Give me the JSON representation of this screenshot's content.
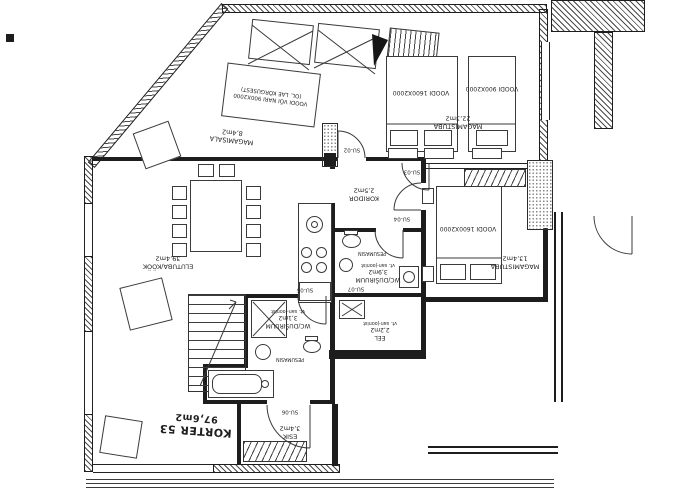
{
  "plan": {
    "title": "KORTER 53",
    "title_area": "97,6m2",
    "rooms": {
      "elutuba": {
        "name": "ELUTUBA/KÖÖK",
        "area": "39,4m2"
      },
      "magamisala": {
        "name": "MAGAMISALA",
        "area": "8,4m2"
      },
      "magamistuba_suur": {
        "name": "MAGAMISTUBA",
        "area": "22,3m2"
      },
      "magamistuba_vaike": {
        "name": "MAGAMISTUBA",
        "area": "13,4m2"
      },
      "koridor": {
        "name": "KORIDOR",
        "area": "2,5m2"
      },
      "wc_suur": {
        "name": "WC/DUŠIRUUM",
        "area": "3,9m2",
        "note": "vt. san-joonist"
      },
      "wc_vaike": {
        "name": "WC/DUŠIRUUM",
        "area": "3,1m2",
        "note": "vt. san-joonist"
      },
      "eel": {
        "name": "EEL",
        "area": "2,2m2",
        "note": "vt. san-joonist"
      },
      "esik": {
        "name": "ESIK",
        "area": "3,4m2"
      }
    },
    "furniture_labels": {
      "bed_master": "VOODI 1600X2000",
      "bed_single": "VOODI 900X2000",
      "bed_second": "VOODI 1600X2000",
      "bed_loft_line1": "VOODI VÕI NARI 900X2000",
      "bed_loft_line2": "(OL. LAE KÕRGUSEST)",
      "washer_upper": "PESUMASIN",
      "washer_lower": "PESUMASIN"
    },
    "door_tags": {
      "su02": "SU-02",
      "su03": "SU-03",
      "su04": "SU-04",
      "su05": "SU-05",
      "su06": "SU-06",
      "su07": "SU-07"
    },
    "colors": {
      "line": "#1d1d1d",
      "paper": "#ffffff"
    }
  }
}
